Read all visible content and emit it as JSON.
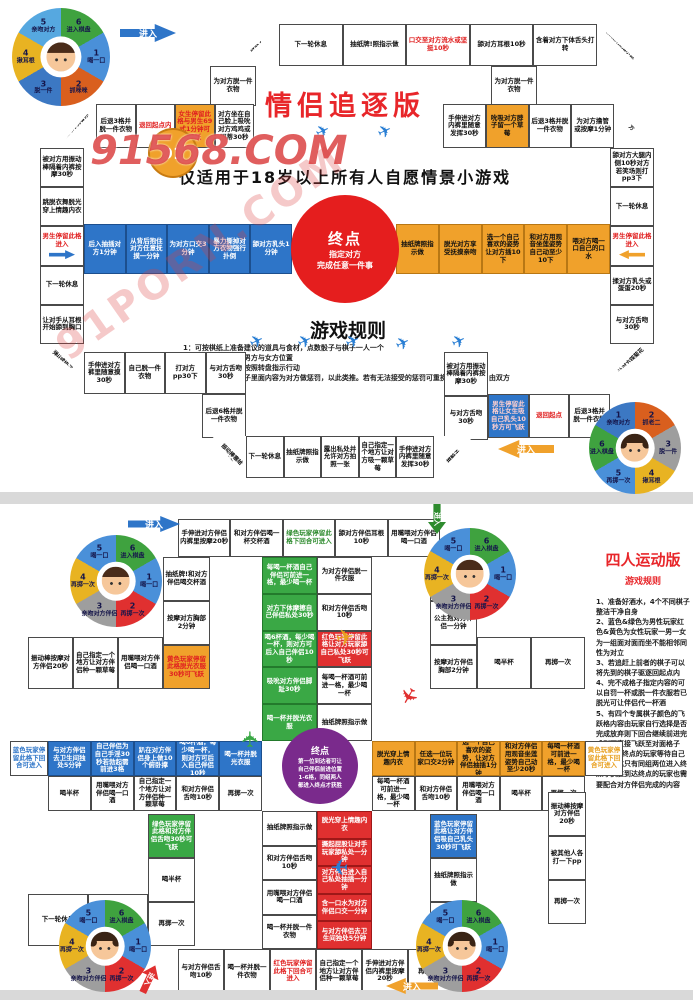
{
  "watermark": {
    "badge": "91",
    "main": "91568.COM",
    "diagonal": "91PORN.COM"
  },
  "board1": {
    "title": "情侣追逐版",
    "subtitle": "仅适用于18岁以上所有人自愿情景小游戏",
    "enter_label": "进入",
    "center": {
      "title": "终点",
      "sub": "指定对方\n完成任意一件事"
    },
    "rules_title": "游戏规则",
    "rules": [
      "1：可按棋纸上准备建议的道具与食材，点数骰子与棋子一人一个",
      "2：将棋子分别放置男方与女方位置",
      "3：掷骰子掷到几点按照转盘指示行动",
      "4：对应格子按照格子里面内容为对方做惩罚，以此类推。若有无法接受的惩罚可重换或向前一步，由双方决定。"
    ],
    "wheel_tl": {
      "avatar": "m",
      "segments": [
        {
          "n": "6",
          "label": "进入棋盘",
          "color": "#3fa23f"
        },
        {
          "n": "1",
          "label": "喝一口",
          "color": "#4a90d9"
        },
        {
          "n": "2",
          "label": "抓咪咪",
          "color": "#d95f1e"
        },
        {
          "n": "3",
          "label": "脱一件",
          "color": "#3c78c3"
        },
        {
          "n": "4",
          "label": "揪耳根",
          "color": "#e8b322"
        },
        {
          "n": "5",
          "label": "亲吻对方",
          "color": "#56a8e0"
        }
      ]
    },
    "wheel_br": {
      "avatar": "f",
      "segments": [
        {
          "n": "2",
          "label": "抓老二",
          "color": "#d95f1e"
        },
        {
          "n": "3",
          "label": "脱一件",
          "color": "#9e9e9e"
        },
        {
          "n": "4",
          "label": "揪耳根",
          "color": "#e8b322"
        },
        {
          "n": "5",
          "label": "再掷一次",
          "color": "#4a90d9"
        },
        {
          "n": "6",
          "label": "进入棋盘",
          "color": "#3fa23f"
        },
        {
          "n": "1",
          "label": "亲吻对方",
          "color": "#3c78c3"
        }
      ]
    },
    "tracks": {
      "outer_top": [
        {
          "t": "掷骰子",
          "diag": "nw",
          "f": 46
        },
        "下一轮休息",
        "抽纸牌!照指示做",
        {
          "t": "口交至对方流水或坚挺10秒",
          "fg": "#e02020"
        },
        "舔对方耳根10秒",
        "含着对方下体舌头打转",
        {
          "t": "抽纸牌按指示做",
          "diag": "ne",
          "f": 46
        }
      ],
      "step_left": [
        "为对方脱一件衣物"
      ],
      "step_right": [
        "为对方脱一件衣物"
      ],
      "inner_top_left": [
        {
          "t": "让对方骑着你",
          "diag": "nw",
          "f": 38
        },
        "后退3格并脱一件衣物",
        {
          "t": "退回起点内",
          "fg": "#e02020"
        },
        {
          "t": "女生停留此格与男生69式1分钟可飞跃",
          "bg": "#f0a12b",
          "fg": "#e02020"
        },
        "对方坐在自己脸上吸吮对方鸡鸡或阴蒂30秒"
      ],
      "inner_top_right": [
        "手伸进对方内裤里随意发挥30秒",
        {
          "t": "吮吸对方脖子留一个草莓",
          "bg": "#f0a12b"
        },
        "后退3格并脱一件衣物",
        "为对方撸管或按摩1分钟",
        {
          "t": "振动棒塞给对方",
          "diag": "ne",
          "f": 38
        }
      ],
      "left_col": [
        "被对方用振动棒隔着内裤按摩30秒",
        "跳脱衣舞脱光穿上情趣内衣",
        {
          "t": "男生停留此格进入",
          "fg": "#e02020",
          "arrow": "right",
          "ac": "#2e75c8"
        },
        "下一轮休息",
        "让对手从耳根开始舔到胸口",
        {
          "t": "弹jj或奶子",
          "diag": "sw",
          "f": 34
        }
      ],
      "right_col": [
        "舔对方大腿内侧10秒对方若笑场则打pp3下",
        "下一轮休息",
        {
          "t": "男生停留此格进入",
          "fg": "#e02020",
          "arrow": "left",
          "ac": "#f0a12b"
        },
        "揉对方乳头或蛋蛋20秒",
        "与对方舌吻30秒",
        {
          "t": "让对方踩菊花",
          "diag": "se",
          "f": 34
        }
      ],
      "blue_row": [
        "后入抽插对方1分钟",
        "从背后抱住对方任意抚摸一分钟",
        "为对方口交3分钟",
        "暴力撕掉对方衣物强行扑倒",
        "舔对方乳头1分钟"
      ],
      "orange_row": [
        "抽纸牌照指示做",
        "脱光对方享受抚摸亲吻",
        "选一个自己喜欢的姿势让对方插10下",
        "和对方用观音坐莲姿势自己动至少10下",
        "喂对方喝一口自己的口水"
      ],
      "bottom_inner_left": [
        "手伸进对方裤里随意摸30秒",
        "自己脱一件衣物",
        "打对方pp30下",
        "与对方舌吻30秒"
      ],
      "below_left": [
        "后退6格并脱一件衣物"
      ],
      "right_stack": [
        "被对方用振动棒隔着内裤按摩30秒",
        "与对方舌吻30秒"
      ],
      "bottom_inner_right_row": [
        {
          "t": "男生停留此格让女生吸自己乳头10秒方可飞跃",
          "bg": "#2e75c8",
          "fg": "#ffd0d0"
        },
        {
          "t": "退回起点",
          "fg": "#e02020"
        },
        "后退3格并脱一件衣物"
      ],
      "bottom_outer": [
        {
          "t": "振动棒塞给对方",
          "diag": "sw",
          "f": 34
        },
        "下一轮休息",
        "抽纸牌照指示做",
        "露出私处并允许对方拍照一张",
        "自己指定一个地方让对方吸一颗草莓",
        "手伸进对方内裤里随意发挥30秒",
        {
          "t": "掷骰子",
          "diag": "se",
          "f": 40
        }
      ]
    }
  },
  "board2": {
    "enter_label": "进入",
    "panel": {
      "title": "四人运动版",
      "subtitle": "游戏规则",
      "rules": [
        "1、准备好酒水，4个不同棋子整洁干净自身",
        "2、蓝色&绿色为男性玩家红色&黄色为女性玩家一男一女为一组面对面而坐不能相邻同性为对立",
        "3、若追赶上前者的棋子可以将先到的棋子驱逐回起点内",
        "4、完不成格子指定内容的可以自罚一杯或脱一件衣服若已脱光可让伴侣代一杯酒",
        "5、有四个专属棋子颜色的飞跃格内容由玩家自行选择是否完成放弃则下回合继续前进完成则可直接飞跃至对面格子",
        "6、先到终点的玩家等待自己伴侣到达只有同组两位进入终点才获胜到达终点的玩家也需要配合对方伴侣完成的内容"
      ]
    },
    "center": {
      "title": "终点",
      "sub": "第一位到达者可让\n自己伴侣前进位置\n1-6格，同组两人\n都进入终点才获胜"
    },
    "wheel_labels": {
      "avatar_tl": "m",
      "avatar_tr": "m",
      "avatar_bl": "f",
      "avatar_br": "f"
    },
    "wheel_tl": {
      "avatar": "m",
      "segments": [
        {
          "n": "6",
          "label": "进入棋盘",
          "color": "#3fa23f"
        },
        {
          "n": "1",
          "label": "喝一口",
          "color": "#4a90d9"
        },
        {
          "n": "2",
          "label": "再掷一次",
          "color": "#e03030"
        },
        {
          "n": "3",
          "label": "亲吻对方伴侣",
          "color": "#9e9e9e"
        },
        {
          "n": "4",
          "label": "再掷一次",
          "color": "#e8b322"
        },
        {
          "n": "5",
          "label": "喝一口",
          "color": "#4a90d9"
        }
      ]
    },
    "wheel_tr": {
      "avatar": "m",
      "segments": [
        {
          "n": "6",
          "label": "进入棋盘",
          "color": "#3fa23f"
        },
        {
          "n": "1",
          "label": "喝一口",
          "color": "#4a90d9"
        },
        {
          "n": "2",
          "label": "再掷一次",
          "color": "#e03030"
        },
        {
          "n": "3",
          "label": "亲吻对方伴侣",
          "color": "#9e9e9e"
        },
        {
          "n": "4",
          "label": "再掷一次",
          "color": "#e8b322"
        },
        {
          "n": "5",
          "label": "喝一口",
          "color": "#4a90d9"
        }
      ]
    },
    "wheel_bl": {
      "avatar": "f",
      "segments": [
        {
          "n": "6",
          "label": "进入棋盘",
          "color": "#3fa23f"
        },
        {
          "n": "1",
          "label": "喝一口",
          "color": "#4a90d9"
        },
        {
          "n": "2",
          "label": "再掷一次",
          "color": "#e03030"
        },
        {
          "n": "3",
          "label": "亲吻对方伴侣",
          "color": "#9e9e9e"
        },
        {
          "n": "4",
          "label": "再掷一次",
          "color": "#e8b322"
        },
        {
          "n": "5",
          "label": "喝一口",
          "color": "#4a90d9"
        }
      ]
    },
    "wheel_br": {
      "avatar": "f",
      "segments": [
        {
          "n": "6",
          "label": "进入棋盘",
          "color": "#3fa23f"
        },
        {
          "n": "1",
          "label": "喝一口",
          "color": "#4a90d9"
        },
        {
          "n": "2",
          "label": "再掷一次",
          "color": "#e03030"
        },
        {
          "n": "3",
          "label": "亲吻对方伴侣",
          "color": "#9e9e9e"
        },
        {
          "n": "4",
          "label": "再掷一次",
          "color": "#e8b322"
        },
        {
          "n": "5",
          "label": "喝一口",
          "color": "#4a90d9"
        }
      ]
    },
    "tracks": {
      "top_edge": [
        "手伸进对方伴侣内裤里按摩20秒",
        "和对方伴侣喝一杯交杯酒",
        {
          "t": "绿色玩家停留此格下回合可进入",
          "fg": "#2e8b2e"
        },
        "舔对方伴侣耳根10秒",
        "用嘴喂对方伴侣喝一口酒"
      ],
      "tl_col": [
        "抽纸牌!和对方伴侣喝交杯酒",
        "按摩对方胸部2分钟",
        {
          "t": "黄色玩家停留此格脱光衣服30秒可飞跃",
          "bg": "#f0a12b",
          "fg": "#e02020"
        }
      ],
      "tl_row": [
        "振动棒按摩对方伴侣20秒",
        "自己指定一个地方让对方伴侣种一颗草莓",
        "用嘴喂对方伴侣喝一口酒"
      ],
      "tr_col": [
        "和对方伴侣舌吻10秒",
        "公主抱对方伴侣一分钟",
        "按摩对方伴侣胸部2分钟"
      ],
      "tr_row": [
        "喝半杯",
        "再掷一次"
      ],
      "green_col": [
        "每喝一杯酒自己伴侣可前进一格，最少喝一杯",
        "对方下体摩擦自己伴侣私处30秒",
        "喝6杯酒，每少喝一杯，则对方可后入自己伴侣10秒",
        "吸吮对方伴侣脚趾30秒",
        "喝一杯并脱光衣服"
      ],
      "top_white_col": [
        "为对方伴侣脱一件衣服",
        "和对方伴侣舌吻10秒",
        {
          "t": "红色玩家停留此格让对方玩家舔自己私处30秒可飞跃",
          "bg": "#e03030",
          "fg": "#fff"
        },
        "每喝一杯酒可前进一格，最少喝一杯",
        "抽纸牌照指示做"
      ],
      "left_entry": [
        {
          "t": "蓝色玩家停留此格下回合可进入",
          "fg": "#2e75c8"
        }
      ],
      "blue_row": [
        "与对方伴侣去卫生间独处5分钟",
        "自己伴侣为自己手淫30秒若勃起需前进3格",
        "趴在对方伴侣身上做10个俯卧撑",
        "喝6杯酒，每少喝一杯，则对方可后入自己伴侣10秒",
        "喝一杯并脱光衣服"
      ],
      "left_white_row": [
        "喝半杯",
        "用嘴喂对方伴侣喝一口酒",
        "自己指定一个地方让对方伴侣种一颗草莓",
        "和对方伴侣舌吻10秒",
        "再掷一次"
      ],
      "orange_row": [
        "脱光穿上情趣内衣",
        "任选一位玩家口交2分钟",
        "选一个自己喜欢的姿势，让对方伴侣抽插1分钟",
        "和对方伴侣用观音坐莲姿势自己动至少20秒",
        "每喝一杯酒可前进一格，最少喝一杯"
      ],
      "right_white_row": [
        "每喝一杯酒可前进一格，最少喝一杯",
        "和对方伴侣舌吻10秒",
        "用嘴喂对方伴侣喝一口酒",
        "喝半杯",
        "再掷一次"
      ],
      "right_entry": [
        {
          "t": "黄色玩家停留此格下回合可进入",
          "fg": "#e8a020"
        }
      ],
      "bottom_white_col": [
        "抽纸牌照指示做",
        "和对方伴侣舌吻10秒",
        "用嘴喂对方伴侣喝一口酒",
        "喝一杯并脱一件衣物"
      ],
      "red_col": [
        "脱光穿上情趣内衣",
        "撅起屁股让对手玩家舔私处一分钟",
        "对方伴侣进入自己私处抽插一分钟",
        "含一口水为对方伴侣口交一分钟",
        "与对方伴侣去卫生间独处5分钟"
      ],
      "bottom_edge": [
        "与对方伴侣舌吻10秒",
        "喝一杯并脱一件衣物",
        {
          "t": "红色玩家停留此格下回合可进入",
          "fg": "#e02020"
        },
        "自己指定一个地方让对方伴侣种一颗草莓",
        "手伸进对方伴侣内裤里按摩20秒",
        "再掷一次"
      ],
      "bl_col": [
        {
          "t": "绿色玩家停留此格和对方伴侣舌吻30秒可飞跃",
          "bg": "#3aa845",
          "fg": "#fff"
        },
        "喝半杯",
        "再掷一次"
      ],
      "bl_row": [
        "下一轮休息",
        "抽纸牌照指示做"
      ],
      "br_col": [
        {
          "t": "蓝色玩家停留此格让对方伴侣吸自己乳头30秒可飞跃",
          "bg": "#2e75c8",
          "fg": "#fff"
        },
        "抽纸牌照指示做",
        "和对方伴侣舌吻10秒"
      ],
      "br_edge_col": [
        "振动棒按摩对方伴侣20秒",
        "被其他人各打一下pp",
        "再掷一次"
      ]
    }
  }
}
